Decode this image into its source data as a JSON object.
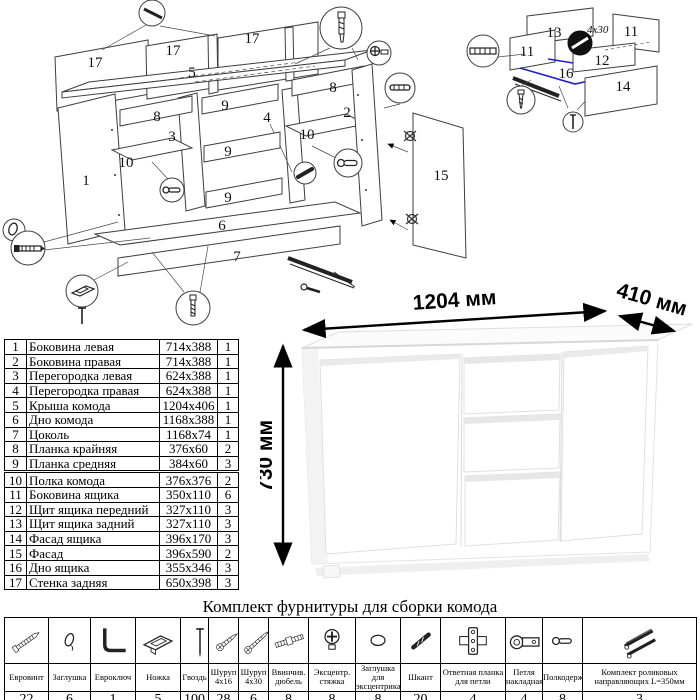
{
  "main_diagram": {
    "labels": [
      "17",
      "17",
      "17",
      "5",
      "8",
      "8",
      "3",
      "4",
      "9",
      "9",
      "9",
      "10",
      "10",
      "1",
      "2",
      "6",
      "7",
      "15"
    ]
  },
  "drawer_diagram": {
    "labels": [
      "13",
      "11",
      "11",
      "12",
      "16",
      "14"
    ],
    "screw_note": "4x30"
  },
  "dimensions": {
    "width": "1204 мм",
    "depth": "410 мм",
    "height": "730 мм"
  },
  "parts_list": {
    "rows": [
      {
        "n": "1",
        "name": "Боковина левая",
        "size": "714x388",
        "qty": "1"
      },
      {
        "n": "2",
        "name": "Боковина правая",
        "size": "714x388",
        "qty": "1"
      },
      {
        "n": "3",
        "name": "Перегородка левая",
        "size": "624x388",
        "qty": "1"
      },
      {
        "n": "4",
        "name": "Перегородка правая",
        "size": "624x388",
        "qty": "1"
      },
      {
        "n": "5",
        "name": "Крыша комода",
        "size": "1204x406",
        "qty": "1"
      },
      {
        "n": "6",
        "name": "Дно комода",
        "size": "1168x388",
        "qty": "1"
      },
      {
        "n": "7",
        "name": "Цоколь",
        "size": "1168x74",
        "qty": "1"
      },
      {
        "n": "8",
        "name": "Планка крайняя",
        "size": "376x60",
        "qty": "2"
      },
      {
        "n": "9",
        "name": "Планка средняя",
        "size": "384x60",
        "qty": "3"
      },
      {
        "n": "10",
        "name": "Полка комода",
        "size": "376x376",
        "qty": "2"
      },
      {
        "n": "11",
        "name": "Боковина ящика",
        "size": "350x110",
        "qty": "6"
      },
      {
        "n": "12",
        "name": "Щит ящика передний",
        "size": "327x110",
        "qty": "3"
      },
      {
        "n": "13",
        "name": "Щит ящика задний",
        "size": "327x110",
        "qty": "3"
      },
      {
        "n": "14",
        "name": "Фасад ящика",
        "size": "396x170",
        "qty": "3"
      },
      {
        "n": "15",
        "name": "Фасад",
        "size": "396x590",
        "qty": "2"
      },
      {
        "n": "16",
        "name": "Дно ящика",
        "size": "355x346",
        "qty": "3"
      },
      {
        "n": "17",
        "name": "Стенка задняя",
        "size": "650x398",
        "qty": "3"
      }
    ]
  },
  "hardware_kit": {
    "title": "Комплект фурнитуры для сборки комода",
    "items": [
      {
        "icon": "#ic-eurovint",
        "name": "Евровинт",
        "qty": "22"
      },
      {
        "icon": "#ic-zaglushka",
        "name": "Заглушка",
        "qty": "6"
      },
      {
        "icon": "#ic-evroklyuch",
        "name": "Евроключ",
        "qty": "1"
      },
      {
        "icon": "#ic-nozhka",
        "name": "Ножка",
        "qty": "5"
      },
      {
        "icon": "#ic-gvozd",
        "name": "Гвоздь",
        "qty": "100"
      },
      {
        "icon": "#ic-shurup16",
        "name": "Шуруп 4x16",
        "qty": "28"
      },
      {
        "icon": "#ic-shurup30",
        "name": "Шуруп 4x30",
        "qty": "6"
      },
      {
        "icon": "#ic-dyubel",
        "name": "Ввинчив. дюбель",
        "qty": "8"
      },
      {
        "icon": "#ic-excentrik",
        "name": "Эксцентр. стяжка",
        "qty": "8"
      },
      {
        "icon": "#ic-zagl-exc",
        "name": "Заглушка для эксцентрика",
        "qty": "8"
      },
      {
        "icon": "#ic-shkant",
        "name": "Шкант",
        "qty": "20"
      },
      {
        "icon": "#ic-planka",
        "name": "Ответная планка для петли",
        "qty": "4"
      },
      {
        "icon": "#ic-petlya",
        "name": "Петля накладная",
        "qty": "4"
      },
      {
        "icon": "#ic-polkoderzhatel",
        "name": "Полкодержатель",
        "qty": "8"
      },
      {
        "icon": "#ic-napravl",
        "name": "Комплект роликовых направляющих L=350мм",
        "qty": "3"
      }
    ]
  }
}
